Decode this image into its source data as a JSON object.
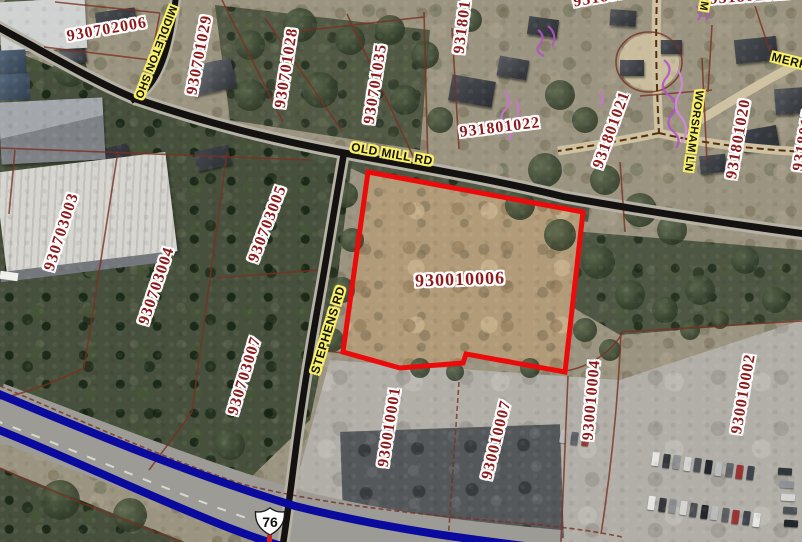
{
  "map": {
    "parcel_labels": [
      {
        "text": "930702006",
        "x": 107,
        "y": 30,
        "rot": -10,
        "size": 16
      },
      {
        "text": "930701029",
        "x": 200,
        "y": 55,
        "rot": -79,
        "size": 16
      },
      {
        "text": "930701028",
        "x": 287,
        "y": 68,
        "rot": -81,
        "size": 16
      },
      {
        "text": "930701035",
        "x": 376,
        "y": 84,
        "rot": -81,
        "size": 16
      },
      {
        "text": "93180101",
        "x": 464,
        "y": 18,
        "rot": -83,
        "size": 16
      },
      {
        "text": "931801",
        "x": 600,
        "y": -2,
        "rot": -10,
        "size": 16
      },
      {
        "text": "931801012",
        "x": 750,
        "y": -3,
        "rot": -4,
        "size": 16
      },
      {
        "text": "931801022",
        "x": 500,
        "y": 128,
        "rot": -7,
        "size": 16
      },
      {
        "text": "931801021",
        "x": 612,
        "y": 130,
        "rot": -70,
        "size": 16
      },
      {
        "text": "931801020",
        "x": 739,
        "y": 139,
        "rot": -80,
        "size": 16
      },
      {
        "text": "9318010",
        "x": 804,
        "y": 140,
        "rot": -80,
        "size": 16
      },
      {
        "text": "930703003",
        "x": 62,
        "y": 232,
        "rot": -72,
        "size": 16
      },
      {
        "text": "930703004",
        "x": 157,
        "y": 286,
        "rot": -71,
        "size": 16
      },
      {
        "text": "930703005",
        "x": 268,
        "y": 224,
        "rot": -69,
        "size": 16
      },
      {
        "text": "930703007",
        "x": 245,
        "y": 376,
        "rot": -73,
        "size": 16
      },
      {
        "text": "930010006",
        "x": 460,
        "y": 279,
        "rot": -2,
        "size": 18
      },
      {
        "text": "930010001",
        "x": 390,
        "y": 427,
        "rot": -81,
        "size": 16
      },
      {
        "text": "930010007",
        "x": 497,
        "y": 440,
        "rot": -76,
        "size": 16
      },
      {
        "text": "930010004",
        "x": 592,
        "y": 400,
        "rot": -85,
        "size": 16
      },
      {
        "text": "930010002",
        "x": 744,
        "y": 394,
        "rot": -80,
        "size": 16
      }
    ],
    "road_labels": [
      {
        "text": "OLD MILL RD",
        "x": 392,
        "y": 154,
        "rot": 10,
        "size": 12
      },
      {
        "text": "STEPHENS RD",
        "x": 328,
        "y": 330,
        "rot": -73,
        "size": 12
      },
      {
        "text": "MIDDLETON SHO",
        "x": 155,
        "y": 52,
        "rot": 111,
        "size": 11
      },
      {
        "text": "WORSHAM LN",
        "x": 693,
        "y": 131,
        "rot": 98,
        "size": 11
      },
      {
        "text": "MERR",
        "x": 790,
        "y": 61,
        "rot": 14,
        "size": 12
      },
      {
        "text": "M",
        "x": 703,
        "y": 6,
        "rot": 100,
        "size": 11
      }
    ],
    "highlighted_parcel": {
      "id": "930010006",
      "outline_color": "#ec0b0b"
    },
    "route_shield": {
      "text": "76"
    },
    "colors": {
      "parcel_label": "#8e1b1b",
      "label_halo": "#ffffff",
      "road_label": "#151504",
      "road_label_halo": "#f8ef6b",
      "parcel_line": "#7a3022",
      "road": "#141210",
      "highway_overlay": "#0a0a9e",
      "scribble": "#b353c6"
    }
  }
}
